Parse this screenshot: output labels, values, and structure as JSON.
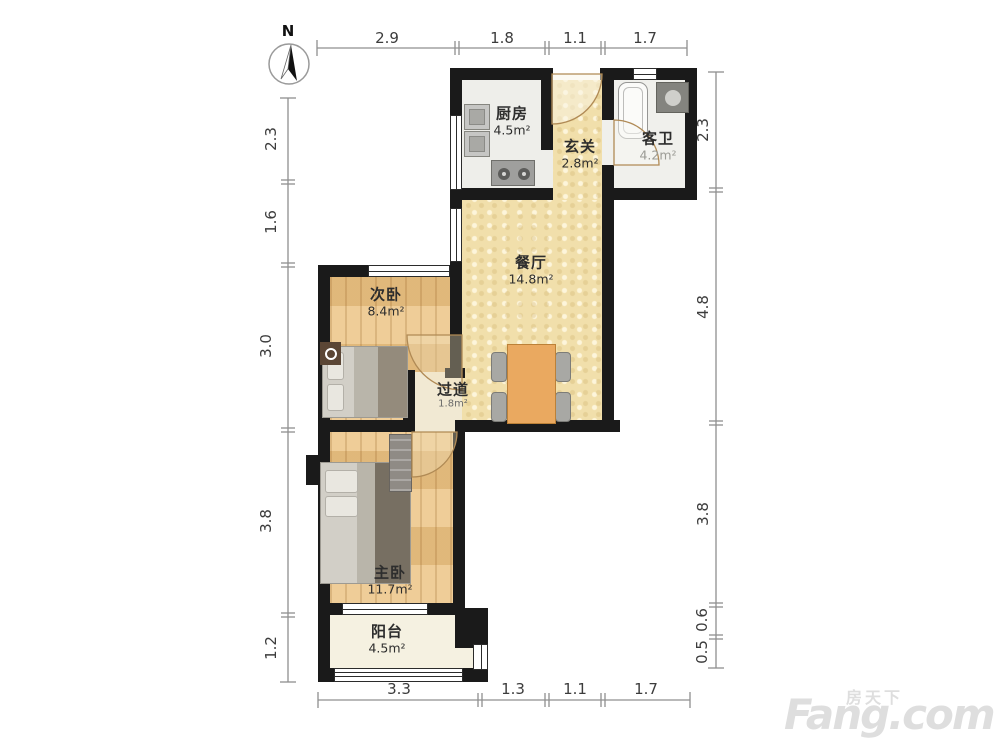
{
  "compass": {
    "label": "N"
  },
  "rooms": {
    "kitchen": {
      "name": "厨房",
      "area": "4.5m²"
    },
    "entry": {
      "name": "玄关",
      "area": "2.8m²"
    },
    "guest_bath": {
      "name": "客卫",
      "area": "4.2m²"
    },
    "dining": {
      "name": "餐厅",
      "area": "14.8m²"
    },
    "second_bedroom": {
      "name": "次卧",
      "area": "8.4m²"
    },
    "hallway": {
      "name": "过道",
      "area": "1.8m²"
    },
    "master_bedroom": {
      "name": "主卧",
      "area": "11.7m²"
    },
    "balcony": {
      "name": "阳台",
      "area": "4.5m²"
    }
  },
  "dimensions": {
    "top": [
      "2.9",
      "1.8",
      "1.1",
      "1.7"
    ],
    "bottom": [
      "3.3",
      "1.3",
      "1.1",
      "1.7"
    ],
    "left": [
      "2.3",
      "1.6",
      "3.0",
      "3.8",
      "1.2"
    ],
    "right": [
      "2.3",
      "4.8",
      "3.8",
      "0.6",
      "0.5"
    ]
  },
  "watermark": {
    "brand_cn": "房天下",
    "brand_en": "Fang.com"
  },
  "colors": {
    "wall": "#1a1a1a",
    "wood_floor": "#e9c184",
    "tile_yellow": "#f1dfab",
    "table_orange": "#eaa960"
  }
}
